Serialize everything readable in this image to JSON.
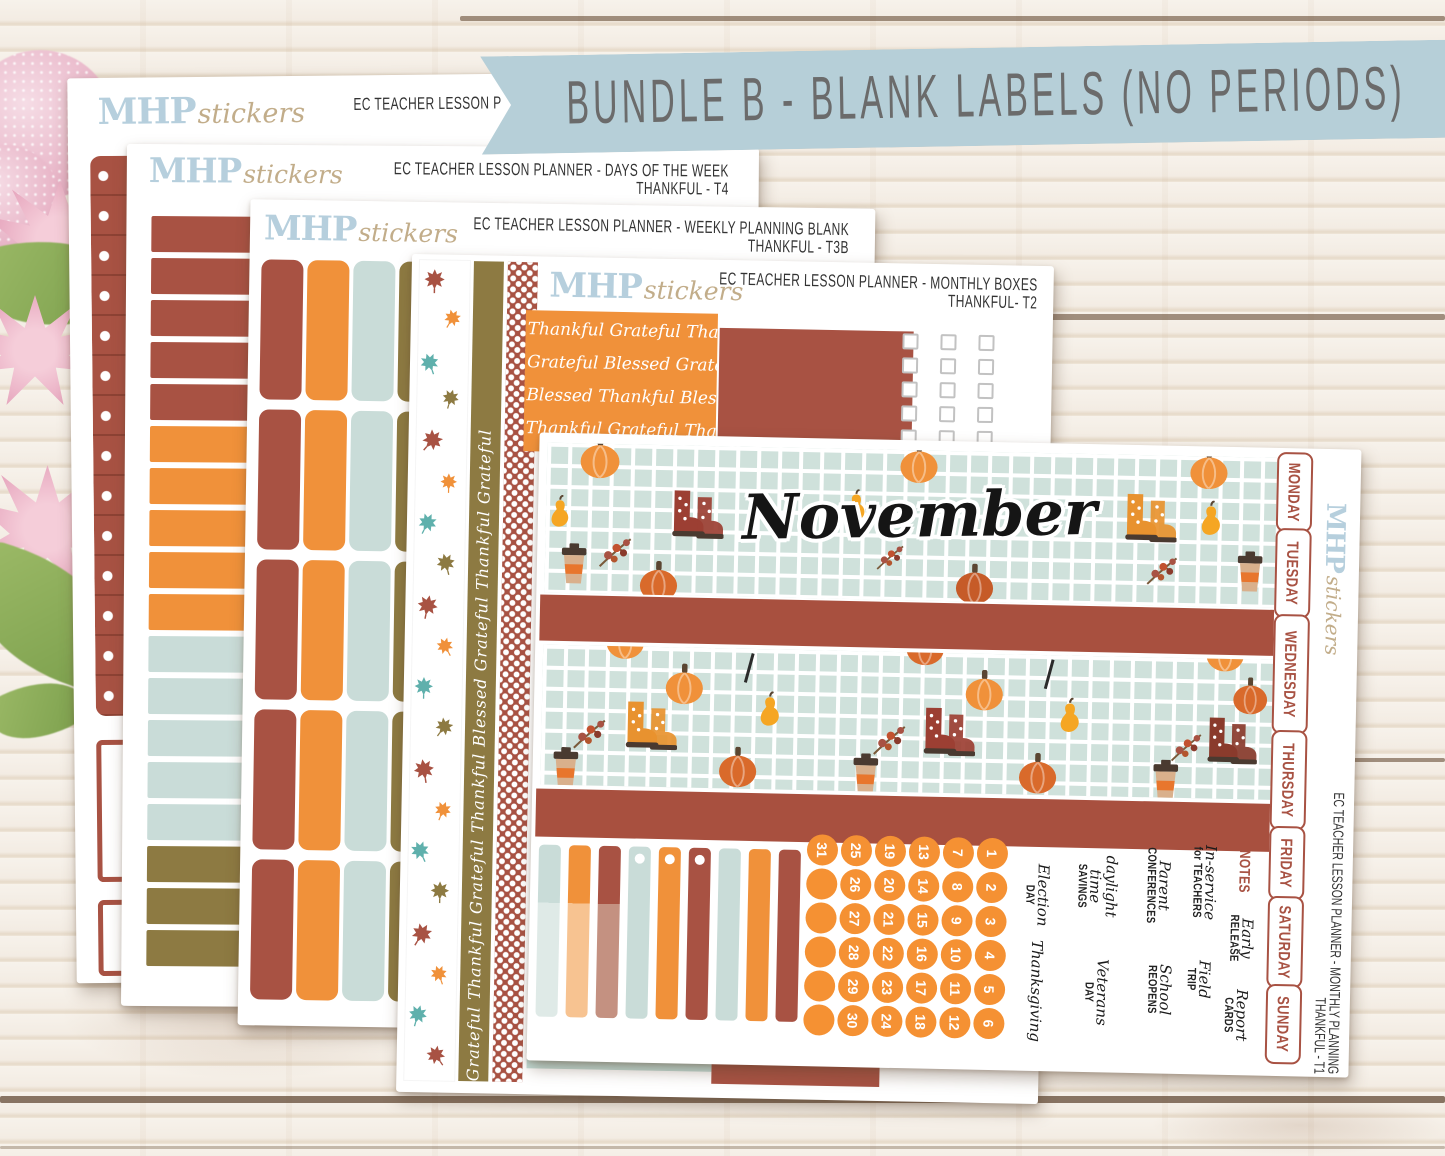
{
  "banner": {
    "text": "BUNDLE B - BLANK LABELS (NO PERIODS)",
    "bg": "#b6cfd8",
    "text_color": "#6b6b6b"
  },
  "brand": {
    "mhp": "MHP",
    "stickers": "stickers",
    "mhp_color": "#b6cfdd",
    "stickers_color": "#c2ad8a"
  },
  "palette": {
    "rust": "#a85243",
    "orange": "#f0913a",
    "light_blue": "#c9dcd8",
    "pale_blue": "#dfeae7",
    "olive": "#8d7a42",
    "peach": "#f7c391",
    "dusty_rose": "#c49181",
    "teal": "#5fa9ac",
    "banner_blue": "#b6cfd8",
    "grid_green": "#cfe1db",
    "date_orange": "#f59133"
  },
  "icons": [
    "pumpkin-icon",
    "pear-icon",
    "rainboots-icon",
    "coffee-cup-icon",
    "berry-sprig-icon",
    "maple-leaf-icon"
  ],
  "sheets": {
    "sheet1": {
      "header1": "EC TEACHER LESSON P"
    },
    "t4": {
      "header1": "EC TEACHER LESSON PLANNER - DAYS OF THE WEEK",
      "header2": "THANKFUL - T4",
      "labels": [
        {
          "text": "MONDAY",
          "count": 5,
          "color": "#a85243"
        },
        {
          "text": "TUESDAY",
          "count": 5,
          "color": "#f0913a"
        },
        {
          "text": "WEDNESDAY",
          "count": 5,
          "color": "#c9dcd8"
        },
        {
          "text": "THURSDAY",
          "count": 3,
          "color": "#8d7a42"
        }
      ]
    },
    "t3b": {
      "header1": "EC TEACHER LESSON PLANNER - WEEKLY PLANNING BLANK",
      "header2": "THANKFUL - T3B",
      "column_colors": [
        "#a85243",
        "#f0913a",
        "#c9dcd8",
        "#8d7a42"
      ],
      "rows": 5
    },
    "t2": {
      "header1": "EC TEACHER LESSON PLANNER - MONTHLY BOXES",
      "header2": "THANKFUL- T2",
      "gratitude": [
        "Thankful Grateful Thankful",
        "Grateful Blessed Grateful",
        "Blessed Thankful Blessed",
        "Thankful Grateful Thankful"
      ],
      "washi_text": "Grateful Thankful Grateful Thankful Blessed Grateful Thankful Grateful",
      "seating_label": "Seating Plans"
    },
    "t1": {
      "header1": "EC TEACHER LESSON PLANNER - MONTHLY PLANNING",
      "header2": "THANKFUL - T1",
      "month": "November",
      "weekdays": [
        "MONDAY",
        "TUESDAY",
        "WEDNESDAY",
        "THURSDAY",
        "FRIDAY",
        "SATURDAY",
        "SUNDAY"
      ],
      "date_columns": [
        [
          "31",
          "",
          "",
          "",
          "",
          ""
        ],
        [
          "25",
          "26",
          "27",
          "28",
          "29",
          "30"
        ],
        [
          "19",
          "20",
          "21",
          "22",
          "23",
          "24"
        ],
        [
          "13",
          "14",
          "15",
          "16",
          "17",
          "18"
        ],
        [
          "7",
          "8",
          "9",
          "10",
          "11",
          "12"
        ],
        [
          "1",
          "2",
          "3",
          "4",
          "5",
          "6"
        ]
      ],
      "events": [
        {
          "id": "election-day",
          "script": "Election",
          "caps": "DAY"
        },
        {
          "id": "daylight-savings",
          "script": "daylight time",
          "caps": "SAVINGS"
        },
        {
          "id": "parent-conferences",
          "script": "Parent",
          "caps": "CONFERENCES"
        },
        {
          "id": "in-service",
          "script": "In-service",
          "caps": "for TEACHERS"
        },
        {
          "id": "notes",
          "script": "",
          "caps": "NOTES"
        },
        {
          "id": "early-release",
          "script": "Early",
          "caps": "RELEASE"
        },
        {
          "id": "thanksgiving",
          "script": "Thanksgiving",
          "caps": ""
        },
        {
          "id": "veterans-day",
          "script": "Veterans",
          "caps": "DAY"
        },
        {
          "id": "school-reopens",
          "script": "School",
          "caps": "REOPENS"
        },
        {
          "id": "field-trip",
          "script": "Field",
          "caps": "TRIP"
        },
        {
          "id": "report-cards",
          "script": "Report",
          "caps": "CARDS"
        }
      ]
    }
  }
}
